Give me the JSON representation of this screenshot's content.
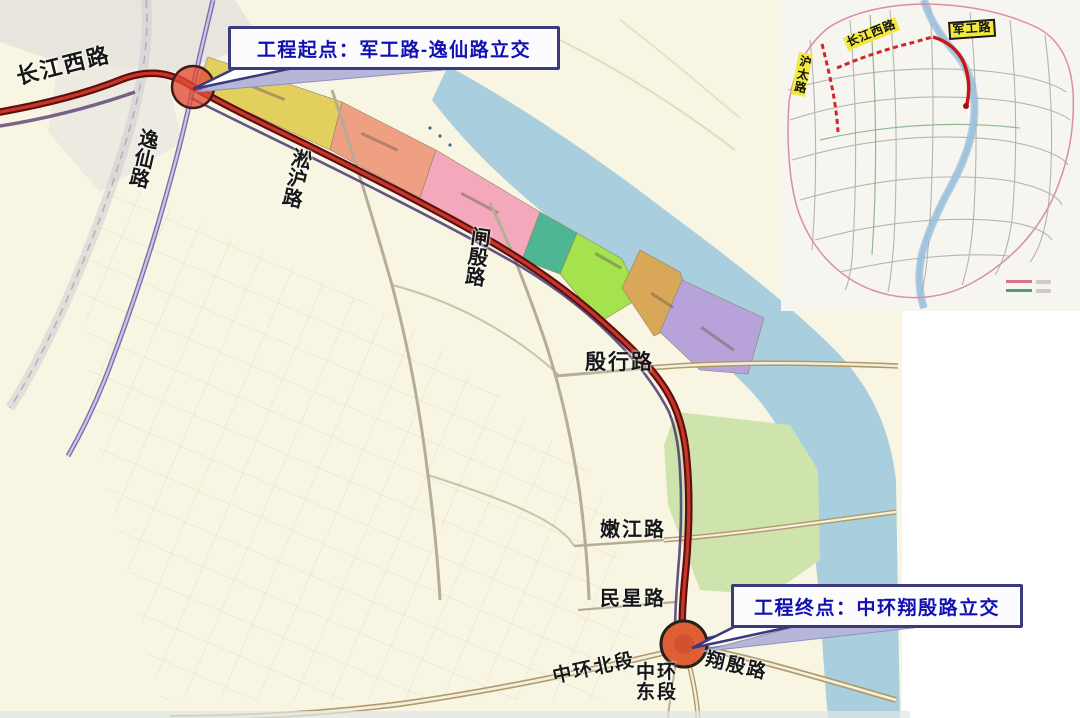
{
  "page": {
    "background": "#ffffff"
  },
  "main_map": {
    "callouts": {
      "start": {
        "text": "工程起点：军工路-逸仙路立交"
      },
      "end": {
        "text": "工程终点：中环翔殷路立交"
      }
    },
    "road_labels": [
      {
        "id": "changjiang-west-road",
        "text": "长江西路",
        "x": 14,
        "y": 66,
        "rotate": -14,
        "vertical": false,
        "size": 22
      },
      {
        "id": "yixian-road",
        "text": "逸仙路",
        "x": 138,
        "y": 126,
        "rotate": 13,
        "vertical": true,
        "size": 20
      },
      {
        "id": "songhu-road",
        "text": "淞沪路",
        "x": 291,
        "y": 146,
        "rotate": 13,
        "vertical": true,
        "size": 20
      },
      {
        "id": "zhayin-road",
        "text": "闸殷路",
        "x": 469,
        "y": 225,
        "rotate": 8,
        "vertical": true,
        "size": 20
      },
      {
        "id": "yinhang-road",
        "text": "殷行路",
        "x": 585,
        "y": 351,
        "rotate": 0,
        "vertical": false,
        "size": 21
      },
      {
        "id": "nenjiang-road",
        "text": "嫩江路",
        "x": 600,
        "y": 520,
        "rotate": 0,
        "vertical": false,
        "size": 20
      },
      {
        "id": "minxing-road",
        "text": "民星路",
        "x": 600,
        "y": 589,
        "rotate": 0,
        "vertical": false,
        "size": 20
      },
      {
        "id": "middle-ring-north-section",
        "text": "中环北段",
        "x": 551,
        "y": 668,
        "rotate": -12,
        "vertical": false,
        "size": 19
      },
      {
        "id": "middle-ring-east-section",
        "text": "中环\n东段",
        "x": 636,
        "y": 663,
        "rotate": 0,
        "vertical": false,
        "size": 19
      },
      {
        "id": "xiangyin-road",
        "text": "翔殷路",
        "x": 708,
        "y": 650,
        "rotate": 13,
        "vertical": false,
        "size": 19
      }
    ],
    "markers": {
      "start_interchange": {
        "x": 193,
        "y": 87
      },
      "end_interchange": {
        "x": 684,
        "y": 644
      }
    },
    "colors": {
      "land": "#f8f6e3",
      "water": "#a9cfdf",
      "route_casing": "#5f0e0e",
      "route_core": "#c5372b",
      "zone_yellow": "#e3cf5e",
      "zone_salmon": "#efa083",
      "zone_pink": "#f3a8bb",
      "zone_teal": "#4fb694",
      "zone_green": "#a4e24e",
      "zone_tan": "#d8a757",
      "zone_purple": "#b7a3da",
      "park_green": "#cfe3ad",
      "elevated_purple": "#7d6fae",
      "major_road": "#b09a6a",
      "callout_border": "#3a3a7c",
      "callout_text": "#1111b0"
    }
  },
  "inset_map": {
    "labels": [
      {
        "id": "changjiang-west-road",
        "text": "长江西路",
        "x": 843,
        "y": 38,
        "rotate": -22,
        "vertical": false,
        "boxed": false
      },
      {
        "id": "jungong-road",
        "text": "军工路",
        "x": 948,
        "y": 22,
        "rotate": -4,
        "vertical": false,
        "boxed": true
      },
      {
        "id": "hutai-road",
        "text": "沪太路",
        "x": 799,
        "y": 52,
        "rotate": 11,
        "vertical": true,
        "boxed": false
      }
    ],
    "legend": {
      "items": [
        {
          "color": "#d87484"
        },
        {
          "color": "#4f9f72"
        }
      ]
    },
    "colors": {
      "river": "#9ec4e0",
      "boundary": "#d98fa2",
      "highlight_solid": "#cc1414",
      "highlight_dashed": "#d42424"
    }
  }
}
